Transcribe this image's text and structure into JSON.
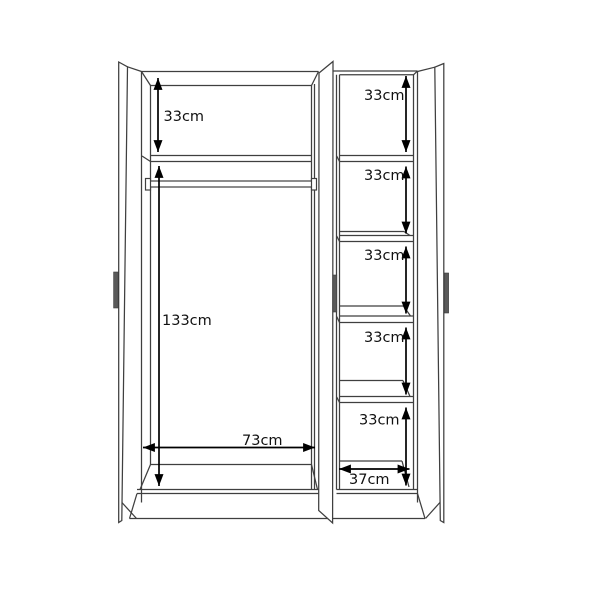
{
  "diagram": {
    "name": "3-door wardrobe internal dimension diagram",
    "unit": "cm",
    "left_section": {
      "top_shelf_height_label": "33cm",
      "top_shelf_height_value": 33,
      "hanging_space_height_label": "133cm",
      "hanging_space_height_value": 133,
      "width_label": "73cm",
      "width_value": 73
    },
    "right_section": {
      "shelf_labels": [
        "33cm",
        "33cm",
        "33cm",
        "33cm",
        "33cm"
      ],
      "shelf_values": [
        33,
        33,
        33,
        33,
        33
      ],
      "width_label": "37cm",
      "width_value": 37
    },
    "colors": {
      "background": "#ffffff",
      "outline": "#3f3f3f",
      "dimension_line": "#000000",
      "label_text": "#111111",
      "handle_fill": "#5a5a5a"
    }
  }
}
